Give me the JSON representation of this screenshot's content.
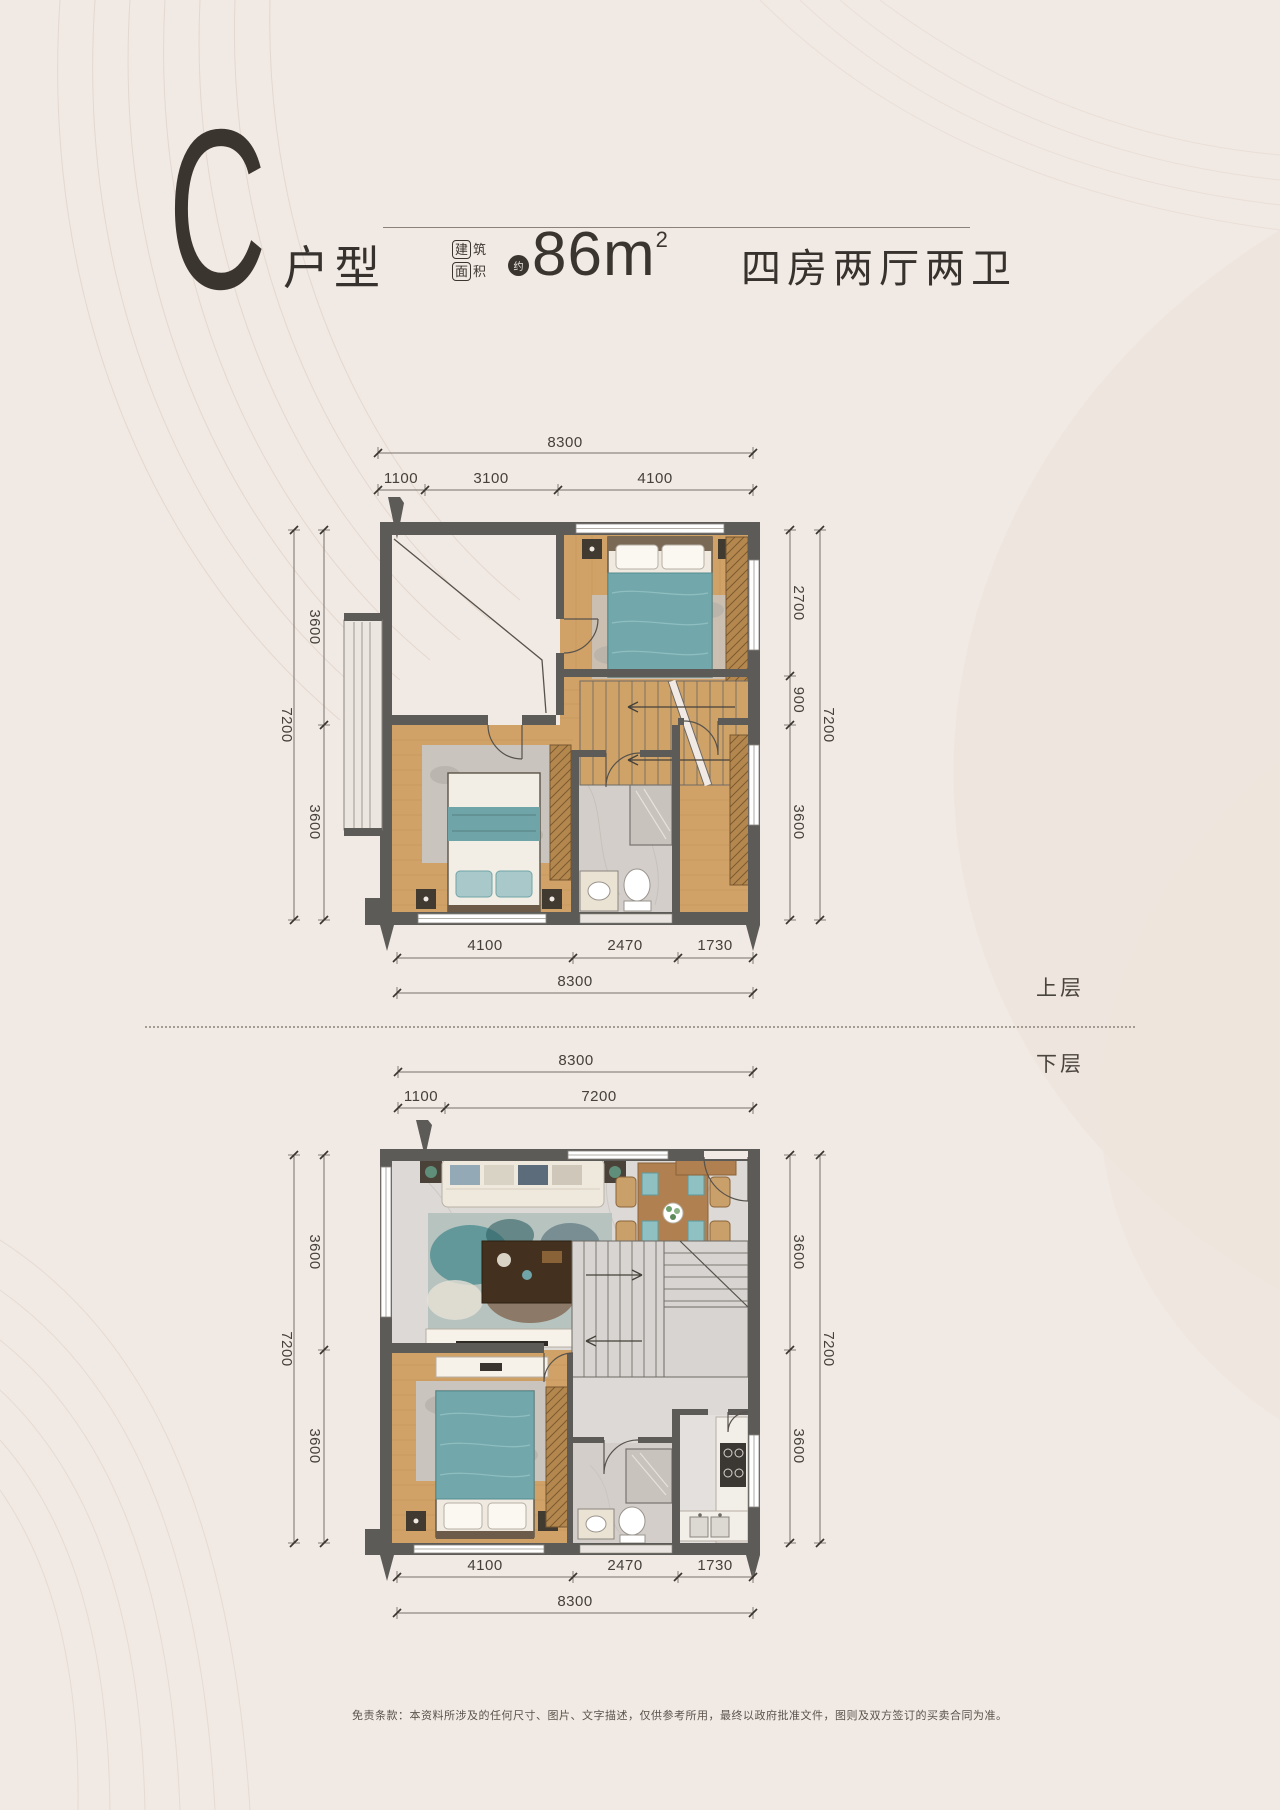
{
  "page": {
    "disclaimer": "免责条款：本资料所涉及的任何尺寸、图片、文字描述，仅供参考所用，最终以政府批准文件，图则及双方签订的买卖合同为准。"
  },
  "header": {
    "unit_letter": "C",
    "unit_label": "户型",
    "badge_l1a": "建",
    "badge_l1b": "筑",
    "badge_l2a": "面",
    "badge_l2b": "积",
    "approx": "约",
    "area_value": "86m",
    "area_sup": "2",
    "layout_desc": "四房两厅两卫"
  },
  "colors": {
    "background": "#f1e9e3",
    "ink": "#3b3530",
    "wall_gray": "#5d5b58",
    "wood_floor": "#d1a267",
    "teal_fabric": "#72a8ab",
    "tile_gray": "#dcd9d6"
  },
  "upper_plan": {
    "floor_label": "上层",
    "top_total": "8300",
    "top_dims": [
      "1100",
      "3100",
      "4100"
    ],
    "left_dims": [
      "3600",
      "3600"
    ],
    "left_total": "7200",
    "right_dims": [
      "2700",
      "900",
      "3600"
    ],
    "right_total": "7200",
    "bottom_dims": [
      "4100",
      "2470",
      "1730"
    ],
    "bottom_total": "8300"
  },
  "lower_plan": {
    "floor_label": "下层",
    "top_total": "8300",
    "top_dims": [
      "1100",
      "7200"
    ],
    "left_dims": [
      "3600",
      "3600"
    ],
    "left_total": "7200",
    "right_dims": [
      "3600",
      "3600"
    ],
    "right_total": "7200",
    "bottom_dims": [
      "4100",
      "2470",
      "1730"
    ],
    "bottom_total": "8300"
  }
}
